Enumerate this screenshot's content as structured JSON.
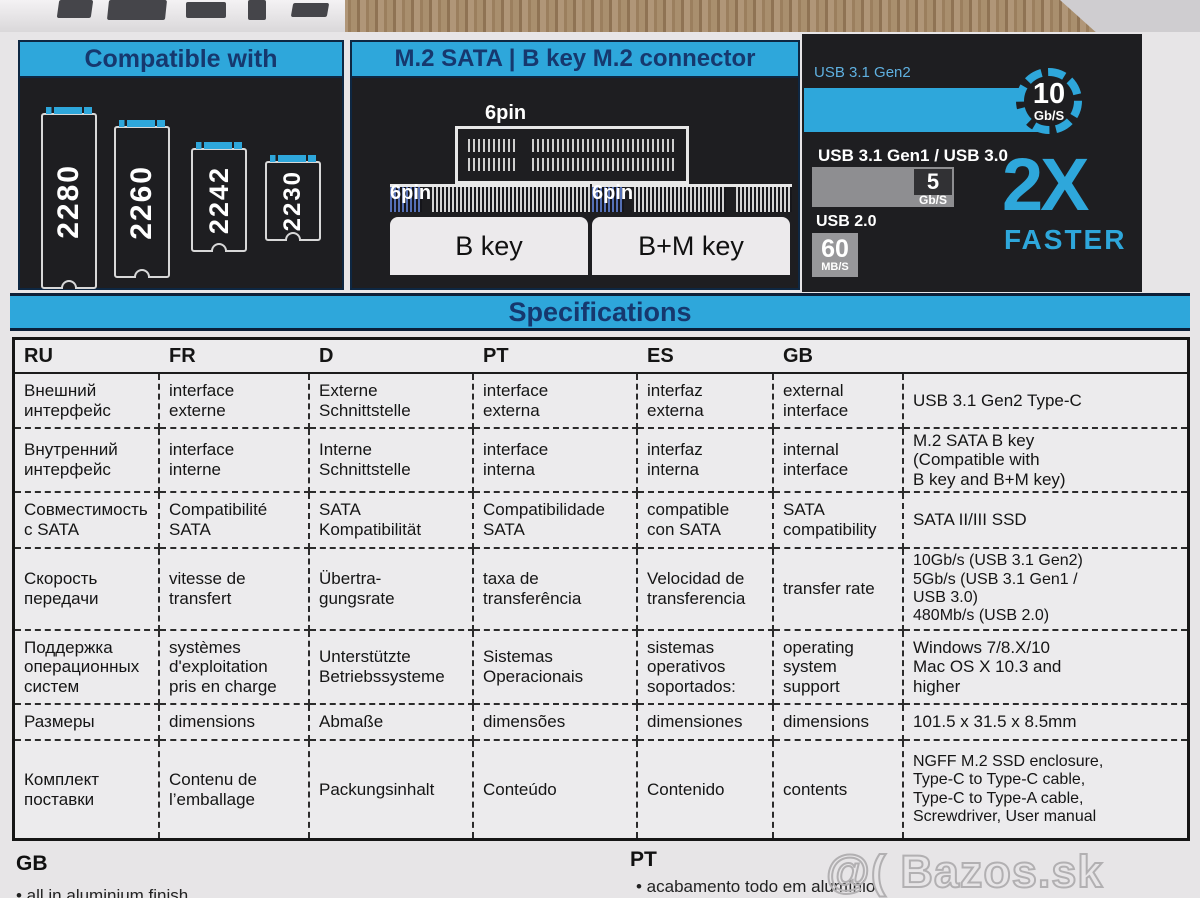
{
  "compatible": {
    "title": "Compatible with",
    "sizes": [
      "2280",
      "2260",
      "2242",
      "2230"
    ]
  },
  "connector": {
    "title": "M.2 SATA | B key M.2 connector",
    "pin_label": "6pin",
    "b_key_label": "B key",
    "bm_key_label": "B+M key"
  },
  "speed": {
    "gen2_label": "USB 3.1 Gen2",
    "gen2_value": "10",
    "gen2_unit": "Gb/S",
    "gen1_label": "USB 3.1 Gen1 / USB 3.0",
    "gen1_value": "5",
    "gen1_unit": "Gb/S",
    "usb2_label": "USB 2.0",
    "usb2_value": "60",
    "usb2_unit": "MB/S",
    "multiplier": "2X",
    "faster": "FASTER"
  },
  "specifications": {
    "title": "Specifications",
    "headers": [
      "RU",
      "FR",
      "D",
      "PT",
      "ES",
      "GB",
      ""
    ],
    "rows": [
      {
        "ru": "Внешний\nинтерфейс",
        "fr": "interface\nexterne",
        "d": "Externe\nSchnittstelle",
        "pt": "interface\nexterna",
        "es": "interfaz\nexterna",
        "gb": "external\ninterface",
        "value": "USB 3.1 Gen2 Type-C"
      },
      {
        "ru": "Внутренний\nинтерфейс",
        "fr": "interface\ninterne",
        "d": "Interne\nSchnittstelle",
        "pt": "interface\ninterna",
        "es": "interfaz\ninterna",
        "gb": "internal\ninterface",
        "value": "M.2 SATA B key\n(Compatible with\nB key and B+M key)"
      },
      {
        "ru": "Совместимость\nс SATA",
        "fr": "Compatibilité\nSATA",
        "d": "SATA\nKompatibilität",
        "pt": "Compatibilidade\nSATA",
        "es": "compatible\ncon SATA",
        "gb": "SATA\ncompatibility",
        "value": "SATA II/III SSD"
      },
      {
        "ru": "Скорость\nпередачи",
        "fr": "vitesse de\ntransfert",
        "d": "Übertra-\ngungsrate",
        "pt": "taxa de\ntransferência",
        "es": "Velocidad de\ntransferencia",
        "gb": "transfer rate",
        "value": "10Gb/s (USB 3.1 Gen2)\n5Gb/s (USB 3.1 Gen1 /\nUSB 3.0)\n480Mb/s (USB 2.0)"
      },
      {
        "ru": "Поддержка\nоперационных\nсистем",
        "fr": "systèmes\nd'exploitation\npris en charge",
        "d": "Unterstützte\nBetriebssysteme",
        "pt": "Sistemas\nOperacionais",
        "es": "sistemas\noperativos\nsoportados:",
        "gb": "operating\nsystem\nsupport",
        "value": "Windows 7/8.X/10\nMac OS X 10.3 and\nhigher"
      },
      {
        "ru": "Размеры",
        "fr": "dimensions",
        "d": "Abmaße",
        "pt": "dimensões",
        "es": "dimensiones",
        "gb": "dimensions",
        "value": "101.5 x 31.5 x 8.5mm"
      },
      {
        "ru": "Комплект\nпоставки",
        "fr": "Contenu de\nl’emballage",
        "d": "Packungsinhalt",
        "pt": "Conteúdo",
        "es": "Contenido",
        "gb": "contents",
        "value": "NGFF M.2 SSD enclosure,\nType-C to Type-C cable,\nType-C to Type-A cable,\nScrewdriver, User manual"
      }
    ]
  },
  "footer": {
    "gb_heading": "GB",
    "gb_bullet": "• all in aluminium finish",
    "pt_heading": "PT",
    "pt_bullet": "• acabamento todo em alumínio"
  },
  "watermark": "@( Bazos.sk",
  "colors": {
    "accent_cyan": "#2EA7DB",
    "navy_text": "#16386E",
    "panel_black": "#1E1E21"
  }
}
